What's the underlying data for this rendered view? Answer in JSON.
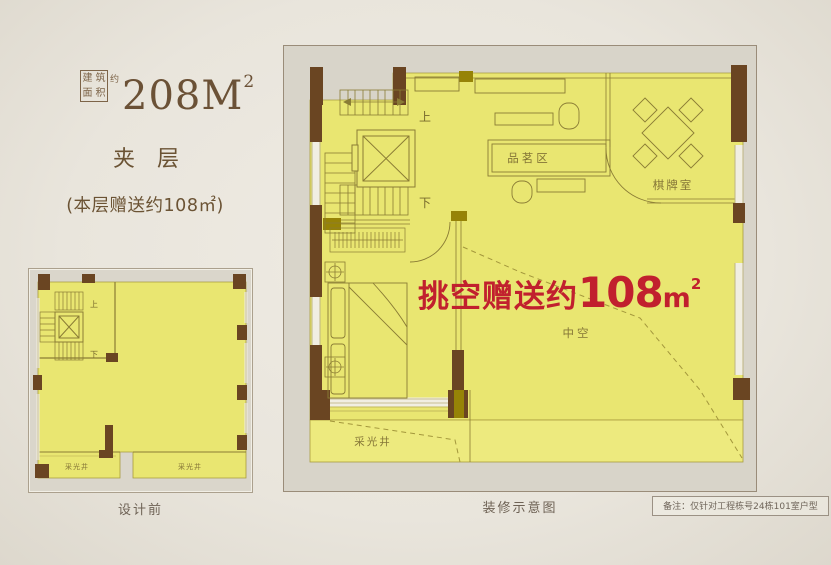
{
  "title": {
    "area_box_chars": [
      "建",
      "筑",
      "面",
      "积"
    ],
    "area_approx": "约",
    "area_value": "208M",
    "area_sup": "2",
    "floor_name": "夹层",
    "floor_note": "(本层赠送约108㎡)"
  },
  "left_plan": {
    "caption": "设计前",
    "labels": {
      "up": "上",
      "down": "下",
      "lightwell_a": "采光井",
      "lightwell_b": "采光井"
    }
  },
  "right_plan": {
    "caption": "装修示意图",
    "labels": {
      "up": "上",
      "down": "下",
      "tea_area": "品茗区",
      "chess_room": "棋牌室",
      "void": "中空",
      "lightwell": "采光井"
    },
    "overlay": {
      "prefix": "挑空赠送约",
      "number": "108",
      "unit": "m",
      "sup": "2"
    }
  },
  "footnote": "备注：仅针对工程栋号24栋101室户型",
  "colors": {
    "page_bg": "#ebe7df",
    "floor_yellow": "#e9e671",
    "lightwell_yellow": "#edea7e",
    "wall_brown": "#6a4522",
    "wall_olive": "#968307",
    "accent_red": "#c1202e",
    "line_olive": "#8a7c35",
    "text_brown": "#6b5334"
  }
}
